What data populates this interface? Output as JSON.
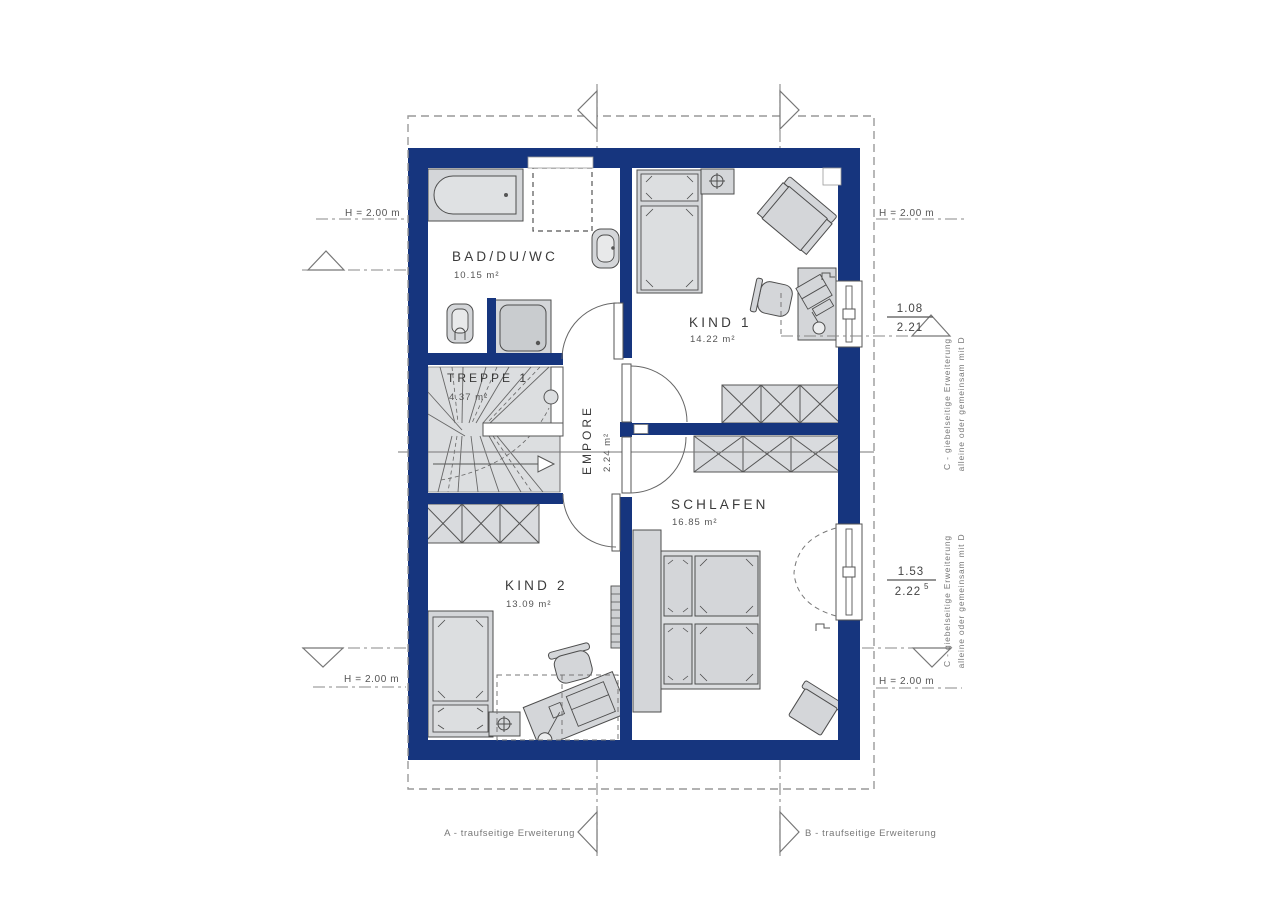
{
  "rooms": {
    "bad": {
      "name": "BAD/DU/WC",
      "area": "10.15 m²"
    },
    "kind1": {
      "name": "KIND 1",
      "area": "14.22 m²"
    },
    "treppe": {
      "name": "TREPPE 1",
      "area": "4.37 m²"
    },
    "empore": {
      "name": "EMPORE",
      "area": "2.24 m²"
    },
    "schlafen": {
      "name": "SCHLAFEN",
      "area": "16.85 m²"
    },
    "kind2": {
      "name": "KIND 2",
      "area": "13.09 m²"
    }
  },
  "markers": {
    "height": "H = 2.00 m"
  },
  "windows": {
    "kind1": {
      "width": "1.08",
      "height": "2.21"
    },
    "schlafen": {
      "width": "1.53",
      "height": "2.22",
      "height_sup": "5"
    }
  },
  "extensions": {
    "a": "A - traufseitige Erweiterung",
    "b": "B - traufseitige Erweiterung",
    "c_line1": "C  - giebelseitige Erweiterung",
    "c_line2": "alleine oder gemeinsam mit D"
  },
  "colors": {
    "wall": "#16357e"
  }
}
